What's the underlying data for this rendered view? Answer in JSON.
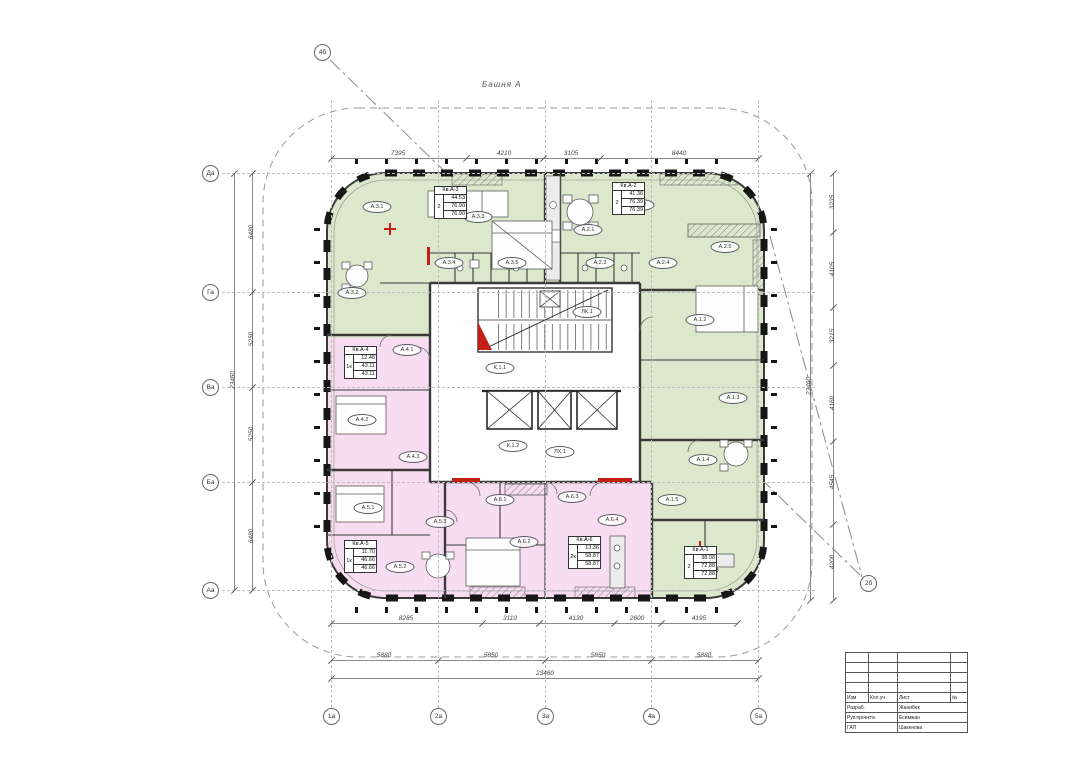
{
  "plan": {
    "tower_label": "Башня А",
    "colors": {
      "green": "#dce8cb",
      "pink": "#f8dcf2",
      "wall": "#1a1a1a",
      "red": "#c22015"
    }
  },
  "axes": {
    "bottom": [
      {
        "label": "1а",
        "x": 331
      },
      {
        "label": "2а",
        "x": 438
      },
      {
        "label": "3а",
        "x": 545
      },
      {
        "label": "4а",
        "x": 651
      },
      {
        "label": "5а",
        "x": 758
      }
    ],
    "left": [
      {
        "label": "Да",
        "y": 173
      },
      {
        "label": "Га",
        "y": 292
      },
      {
        "label": "Ва",
        "y": 387
      },
      {
        "label": "Ба",
        "y": 482
      },
      {
        "label": "Аа",
        "y": 590
      }
    ]
  },
  "markers": [
    {
      "label": "4б",
      "x": 322,
      "y": 52
    },
    {
      "label": "2б",
      "x": 868,
      "y": 583
    }
  ],
  "dims": [
    {
      "type": "h",
      "y": 158,
      "x1": 331,
      "x2": 758,
      "ticks": [
        331,
        466,
        543,
        600,
        758
      ],
      "labels": [
        {
          "x": 398,
          "t": "7395"
        },
        {
          "x": 504,
          "t": "4210"
        },
        {
          "x": 571,
          "t": "3105"
        },
        {
          "x": 679,
          "t": "8440"
        }
      ]
    },
    {
      "type": "h",
      "y": 623,
      "x1": 331,
      "x2": 737,
      "ticks": [
        331,
        482,
        539,
        614,
        661,
        737
      ],
      "labels": [
        {
          "x": 406,
          "t": "8285"
        },
        {
          "x": 510,
          "t": "3110"
        },
        {
          "x": 576,
          "t": "4130"
        },
        {
          "x": 637,
          "t": "2600"
        },
        {
          "x": 699,
          "t": "4195"
        }
      ]
    },
    {
      "type": "h",
      "y": 660,
      "x1": 331,
      "x2": 758,
      "ticks": [
        331,
        438,
        545,
        651,
        758
      ],
      "labels": [
        {
          "x": 384,
          "t": "5880"
        },
        {
          "x": 491,
          "t": "5850"
        },
        {
          "x": 598,
          "t": "5850"
        },
        {
          "x": 704,
          "t": "5880"
        }
      ]
    },
    {
      "type": "h",
      "y": 678,
      "x1": 331,
      "x2": 758,
      "ticks": [
        331,
        758
      ],
      "labels": [
        {
          "x": 545,
          "t": "23460"
        }
      ]
    },
    {
      "type": "v",
      "x": 252,
      "y1": 173,
      "y2": 590,
      "ticks": [
        173,
        292,
        387,
        482,
        590
      ],
      "labels": [
        {
          "y": 232,
          "t": "6480"
        },
        {
          "y": 339,
          "t": "5250"
        },
        {
          "y": 434,
          "t": "5250"
        },
        {
          "y": 536,
          "t": "6480"
        }
      ]
    },
    {
      "type": "v",
      "x": 234,
      "y1": 173,
      "y2": 590,
      "ticks": [
        173,
        590
      ],
      "labels": [
        {
          "y": 380,
          "t": "23460"
        }
      ]
    },
    {
      "type": "v",
      "x": 833,
      "y1": 173,
      "y2": 600,
      "ticks": [
        173,
        232,
        307,
        365,
        441,
        524,
        600
      ],
      "labels": [
        {
          "y": 202,
          "t": "3235"
        },
        {
          "y": 269,
          "t": "4105"
        },
        {
          "y": 336,
          "t": "3215"
        },
        {
          "y": 403,
          "t": "4160"
        },
        {
          "y": 482,
          "t": "4545"
        },
        {
          "y": 562,
          "t": "4200"
        }
      ]
    },
    {
      "type": "v",
      "x": 810,
      "y1": 173,
      "y2": 600,
      "ticks": [
        173,
        600
      ],
      "labels": [
        {
          "y": 386,
          "t": "23460"
        }
      ]
    }
  ],
  "apartments": [
    {
      "id": "Кв.А-3",
      "type": "2",
      "areas": [
        "44.53",
        "76.90",
        "76.90"
      ],
      "x": 434,
      "y": 186
    },
    {
      "id": "Кв.А-2",
      "type": "2",
      "areas": [
        "41.36",
        "76.39",
        "76.39"
      ],
      "x": 612,
      "y": 182
    },
    {
      "id": "Кв.А-4",
      "type": "1к",
      "areas": [
        "12.46",
        "43.11",
        "43.11"
      ],
      "x": 344,
      "y": 346
    },
    {
      "id": "Кв.А-5",
      "type": "1к",
      "areas": [
        "11.70",
        "46.66",
        "46.66"
      ],
      "x": 344,
      "y": 540
    },
    {
      "id": "Кв.А-6",
      "type": "2к",
      "areas": [
        "13.36",
        "58.87",
        "58.87"
      ],
      "x": 568,
      "y": 536
    },
    {
      "id": "Кв.А-1",
      "type": "2",
      "areas": [
        "38.08",
        "72.88",
        "72.88"
      ],
      "x": 684,
      "y": 546
    }
  ],
  "rooms": [
    {
      "label": "А.3.1",
      "x": 377,
      "y": 207
    },
    {
      "label": "А.3.2",
      "x": 352,
      "y": 293
    },
    {
      "label": "А.3.3",
      "x": 478,
      "y": 217
    },
    {
      "label": "А.3.4",
      "x": 449,
      "y": 263
    },
    {
      "label": "А.3.5",
      "x": 512,
      "y": 263
    },
    {
      "label": "А.2.1",
      "x": 588,
      "y": 230
    },
    {
      "label": "А.2.2",
      "x": 640,
      "y": 205
    },
    {
      "label": "А.2.3",
      "x": 600,
      "y": 263
    },
    {
      "label": "А.2.4",
      "x": 663,
      "y": 263
    },
    {
      "label": "А.2.5",
      "x": 725,
      "y": 247
    },
    {
      "label": "А.1.2",
      "x": 700,
      "y": 320
    },
    {
      "label": "А.1.3",
      "x": 733,
      "y": 398
    },
    {
      "label": "А.1.4",
      "x": 703,
      "y": 460
    },
    {
      "label": "А.4.1",
      "x": 407,
      "y": 350
    },
    {
      "label": "А.4.2",
      "x": 362,
      "y": 420
    },
    {
      "label": "А.4.3",
      "x": 413,
      "y": 457
    },
    {
      "label": "А.5.1",
      "x": 368,
      "y": 508
    },
    {
      "label": "А.5.2",
      "x": 400,
      "y": 567
    },
    {
      "label": "А.5.3",
      "x": 440,
      "y": 522
    },
    {
      "label": "А.6.1",
      "x": 500,
      "y": 500
    },
    {
      "label": "А.6.2",
      "x": 524,
      "y": 542
    },
    {
      "label": "А.6.3",
      "x": 572,
      "y": 497
    },
    {
      "label": "А.6.4",
      "x": 612,
      "y": 520
    },
    {
      "label": "А.1.5",
      "x": 672,
      "y": 500
    },
    {
      "label": "А.1.1",
      "x": 704,
      "y": 570
    },
    {
      "label": "ЛК.1",
      "x": 587,
      "y": 312
    },
    {
      "label": "К.1.1",
      "x": 500,
      "y": 368
    },
    {
      "label": "К.1.2",
      "x": 513,
      "y": 446
    },
    {
      "label": "ЛХ.1",
      "x": 560,
      "y": 452
    }
  ],
  "title_block": {
    "x": 845,
    "y": 652,
    "header_cells": [
      "Изм",
      "Кол.уч",
      "Лист",
      "№"
    ],
    "rows": [
      {
        "role": "Разраб.",
        "name": "Жанибек"
      },
      {
        "role": "Рук.проекта",
        "name": "Есимжан"
      },
      {
        "role": "ГАП",
        "name": "Шакенова"
      }
    ]
  }
}
